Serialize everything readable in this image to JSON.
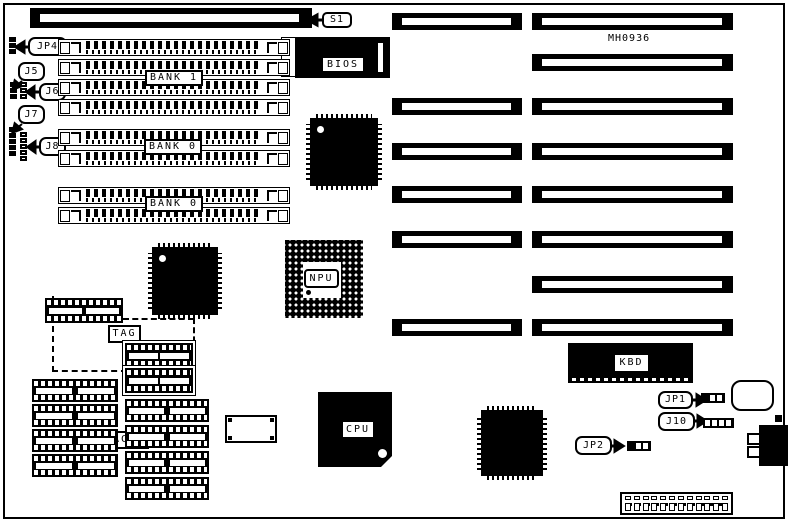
{
  "diagram": {
    "part_number": "MH0936",
    "callouts": {
      "s1": "S1",
      "jp4": "JP4",
      "j5": "J5",
      "j6": "J6",
      "j7": "J7",
      "j8": "J8",
      "jp1": "JP1",
      "j10": "J10",
      "jp2": "JP2"
    },
    "chip_labels": {
      "bios": "BIOS",
      "npu": "NPU",
      "cpu": "CPU",
      "kbd": "KBD",
      "tag": "TAG",
      "cache": "CACHE",
      "u1": "U1",
      "u2": "U2",
      "u3": "U3"
    },
    "bank_labels": {
      "bank1": "BANK 1",
      "bank0_upper": "BANK 0",
      "bank0_lower": "BANK 0"
    },
    "colors": {
      "ink": "#000000",
      "paper": "#ffffff"
    }
  }
}
